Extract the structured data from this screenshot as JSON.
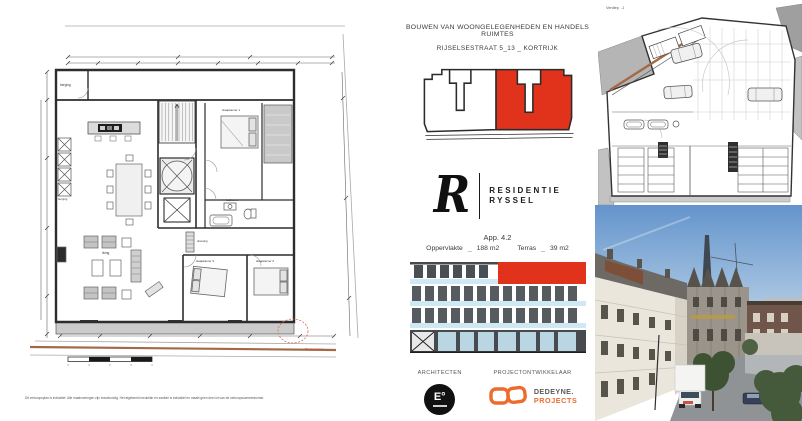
{
  "sheet": {
    "header_line1": "BOUWEN VAN WOONGELEGENHEDEN EN HANDELS RUIMTES",
    "header_line2": "RIJSELSESTRAAT 5_13 _ KORTRIJK"
  },
  "brand": {
    "monogram": "R",
    "name_line1": "RESIDENTIE",
    "name_line2": "RYSSEL"
  },
  "apartment": {
    "title": "App. 4.2",
    "surface_label": "Oppervlakte",
    "surface_sep": "_",
    "surface_value": "188 m2",
    "terrace_label": "Terras",
    "terrace_sep": "_",
    "terrace_value": "39 m2"
  },
  "credits": {
    "architect_label": "ARCHITECTEN",
    "architect_logo_text": "E°",
    "developer_label": "PROJECTONTWIKKELAAR",
    "developer_line1": "DEDEYNE.",
    "developer_line2": "PROJECTS"
  },
  "floor_plan": {
    "room_storage": "berging",
    "room_living": "living",
    "room_bedroom1": "slaapkamer 1",
    "room_bedroom2": "slaapkamer 2",
    "room_bedroom3": "slaapkamer 3",
    "room_bathroom": "badkamer",
    "room_dressing": "dressing",
    "street_annotation": "Rijselsestraat",
    "disclaimer": "Dit verkoopsplan is indicatief. Alle maatvoeringen zijn bouwkundig. Het afgebeeld meubilair en sanitair is indicatief en maakt geen deel uit van de verkoopsovereenkomst."
  },
  "basement_plan": {
    "label": "Verdiep  -1"
  },
  "colors": {
    "accent_red": "#e1331b",
    "brand_orange": "#ed6b2f",
    "glass_blue": "#cfe9f4"
  }
}
